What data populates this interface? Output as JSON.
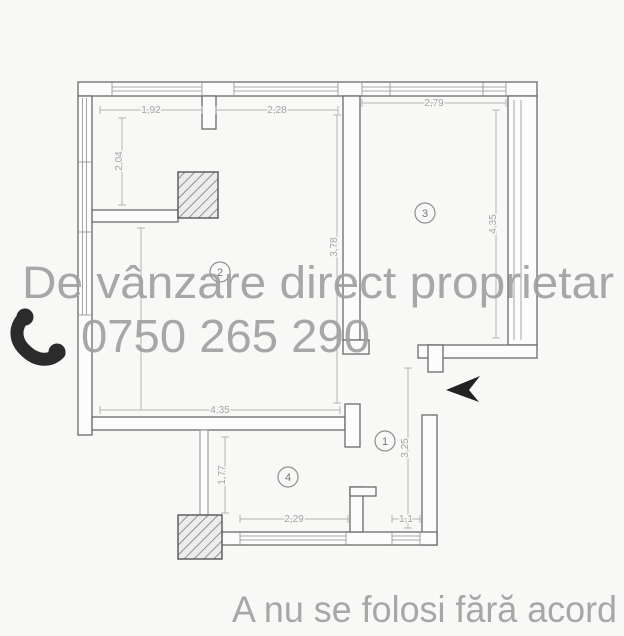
{
  "watermark": {
    "title": "De vânzare direct proprietar",
    "phone": "0750 265 290",
    "footer": "A nu se folosi fără acord",
    "color": "#9f9f9f"
  },
  "floorplan": {
    "type": "apartment-floor-plan",
    "line_color": "#6a6a6a",
    "dim_color": "#a4a4a4",
    "accent_ink": "#222222",
    "rooms": [
      {
        "number": "1"
      },
      {
        "number": "2"
      },
      {
        "number": "3"
      },
      {
        "number": "4"
      }
    ],
    "dimensions": [
      {
        "label": "1,92"
      },
      {
        "label": "2,28"
      },
      {
        "label": "2,79"
      },
      {
        "label": "2,04"
      },
      {
        "label": "3,78"
      },
      {
        "label": "4,35"
      },
      {
        "label": "4,35"
      },
      {
        "label": "1,77"
      },
      {
        "label": "2,29"
      },
      {
        "label": "1,1"
      },
      {
        "label": "3,25"
      }
    ],
    "icons": {
      "phone": "phone-handset-icon",
      "entrance": "entrance-arrow-icon"
    }
  }
}
